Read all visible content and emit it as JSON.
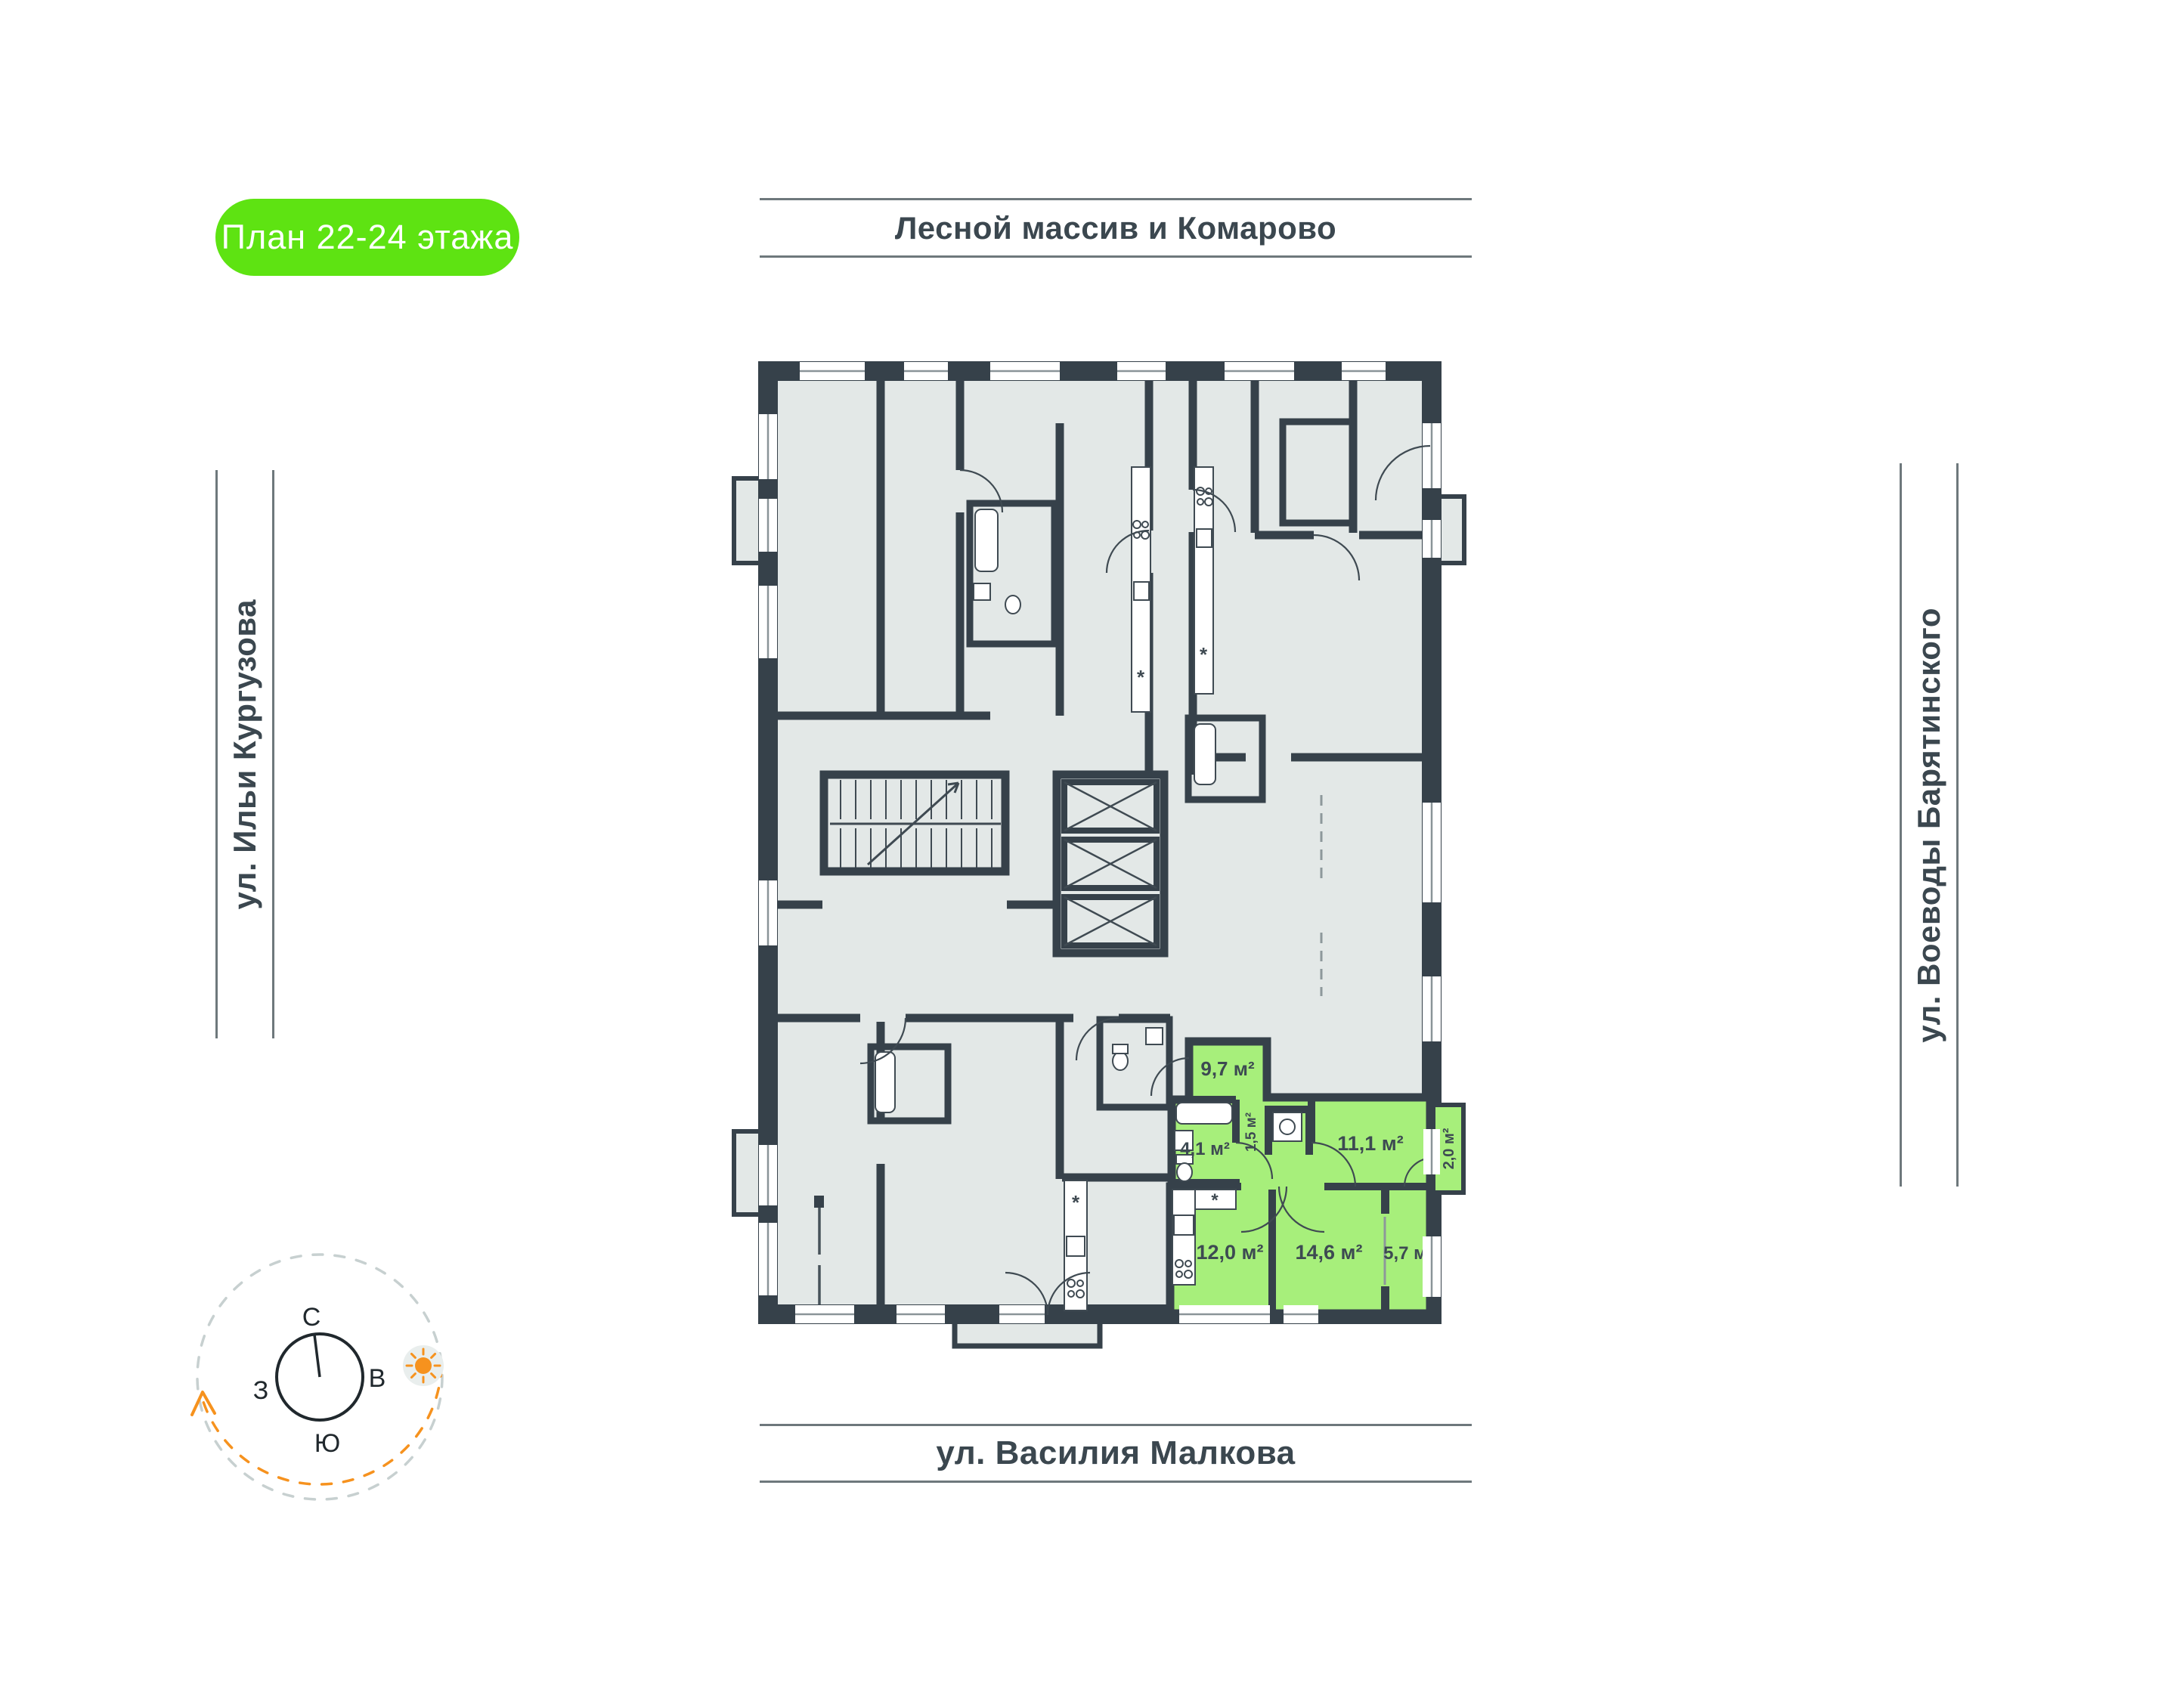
{
  "badge": {
    "label": "План 22-24 этажа"
  },
  "streets": {
    "top": "Лесной массив и Комарово",
    "left": "ул. Ильи Кургузова",
    "right": "ул. Воеводы Барятинского",
    "bottom": "ул. Василия Малкова"
  },
  "compass": {
    "north": "С",
    "east": "В",
    "west": "З",
    "south": "Ю"
  },
  "apartment": {
    "rooms": {
      "hall": "9,7 м²",
      "bathroom": "4,1 м²",
      "storage": "1,5 м²",
      "bedroom": "11,1 м²",
      "balcony": "2,0 м²",
      "kitchen": "12,0 м²",
      "living": "14,6 м²",
      "extra": "5,7 м²"
    }
  },
  "kitchen_icons": {
    "fridge": "*",
    "fridge2": "*",
    "fridge3": "*",
    "fridge4": "*"
  },
  "colors": {
    "accent_green": "#5ee312",
    "room_green": "#a7ef7b",
    "wall": "#36414a",
    "room_fill": "#e3e8e7",
    "orange": "#f6921e",
    "street_text": "#3b474f"
  }
}
